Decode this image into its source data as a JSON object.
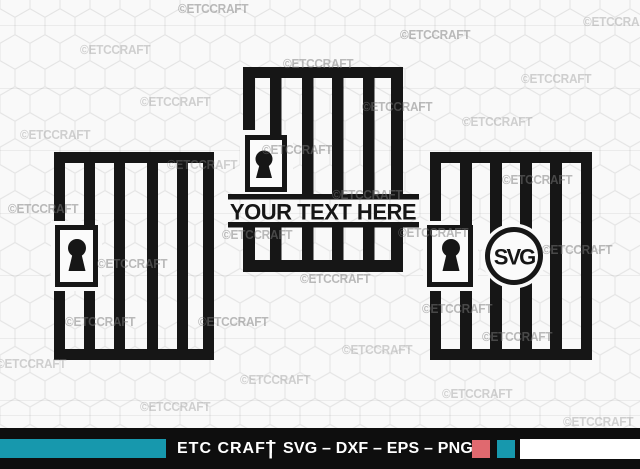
{
  "design_color": "#161616",
  "background": {
    "color": "#f9f9f9",
    "hex_line_color": "#e4e4e4",
    "watermark_text": "©ETCCRAFT"
  },
  "designs": {
    "left_door": "jail door with padlock",
    "middle_door": "jail door split banner with padlock",
    "right_door": "jail door with padlock and circle monogram",
    "middle_banner_text": "YOUR TEXT HERE",
    "monogram_text": "SVG"
  },
  "footer": {
    "brand": "ETC CRAFT",
    "divider": "|",
    "formats": "SVG – DXF – EPS – PNG",
    "bar_color": "#0e0e0e",
    "accent_teal": "#1798ad",
    "accent_red": "#e0696f",
    "accent_white": "#ffffff"
  }
}
